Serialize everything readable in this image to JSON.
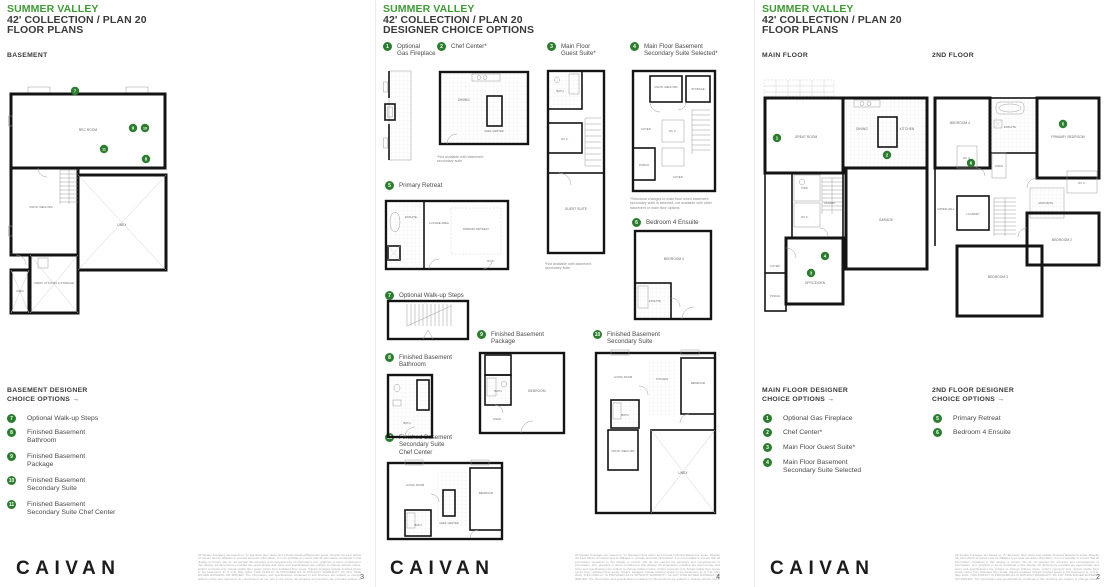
{
  "colors": {
    "accent_green": "#3f9b35",
    "marker_green": "#2c7d2f",
    "wall_black": "#141414"
  },
  "pages": {
    "basement": {
      "title": "SUMMER VALLEY",
      "subtitle": "42' COLLECTION / PLAN 20",
      "doc_type": "FLOOR PLANS",
      "section_label": "BASEMENT",
      "legend_heading": "BASEMENT DESIGNER\nCHOICE OPTIONS →",
      "legend_items": [
        {
          "num": "7",
          "label": "Optional Walk-up Steps"
        },
        {
          "num": "8",
          "label": "Finished Basement\nBathroom"
        },
        {
          "num": "9",
          "label": "Finished Basement\nPackage"
        },
        {
          "num": "10",
          "label": "Finished Basement\nSecondary Suite"
        },
        {
          "num": "11",
          "label": "Finished Basement\nSecondary Suite Chef Center"
        }
      ],
      "page_number": "3"
    },
    "options": {
      "title": "SUMMER VALLEY",
      "subtitle": "42' COLLECTION / PLAN 20",
      "doc_type": "DESIGNER CHOICE OPTIONS",
      "items": [
        {
          "num": "1",
          "label": "Optional\nGas Fireplace"
        },
        {
          "num": "2",
          "label": "Chef Center*",
          "note": "*Not available with basement\nsecondary suite."
        },
        {
          "num": "3",
          "label": "Main Floor\nGuest Suite*",
          "note": "*Not available with basement\nsecondary suite."
        },
        {
          "num": "4",
          "label": "Main Floor Basement\nSecondary Suite Selected*",
          "note": "*Structural changes to main floor when basement\nsecondary suite is selected, not available with other\nbasement or main floor options."
        },
        {
          "num": "5",
          "label": "Primary Retreat"
        },
        {
          "num": "6",
          "label": "Bedroom 4 Ensuite"
        },
        {
          "num": "7",
          "label": "Optional Walk-up Steps"
        },
        {
          "num": "8",
          "label": "Finished Basement\nBathroom"
        },
        {
          "num": "9",
          "label": "Finished Basement\nPackage"
        },
        {
          "num": "10",
          "label": "Finished Basement\nSecondary Suite"
        },
        {
          "num": "11",
          "label": "Finished Basement\nSecondary Suite\nChef Center"
        }
      ],
      "page_number": "4"
    },
    "floors": {
      "title": "SUMMER VALLEY",
      "subtitle": "42' COLLECTION / PLAN 20",
      "doc_type": "FLOOR PLANS",
      "section_label_main": "MAIN FLOOR",
      "section_label_2nd": "2ND FLOOR",
      "legend_main_heading": "MAIN FLOOR DESIGNER\nCHOICE OPTIONS →",
      "legend_main_items": [
        {
          "num": "1",
          "label": "Optional Gas Fireplace"
        },
        {
          "num": "2",
          "label": "Chef Center*"
        },
        {
          "num": "3",
          "label": "Main Floor Guest Suite*"
        },
        {
          "num": "4",
          "label": "Main Floor Basement\nSecondary Suite Selected"
        }
      ],
      "legend_2nd_heading": "2ND FLOOR DESIGNER\nCHOICE OPTIONS →",
      "legend_2nd_items": [
        {
          "num": "5",
          "label": "Primary Retreat"
        },
        {
          "num": "6",
          "label": "Bedroom 4 Ensuite"
        }
      ],
      "page_number": "2"
    }
  },
  "plans": {
    "basement": {
      "rooms": [
        "REC ROOM",
        "UNFIN. MECH RM",
        "UNEX",
        "UNFIN. UTILITIES & STORAGE",
        "UNEX"
      ],
      "markers": [
        "7",
        "9",
        "10",
        "11",
        "8"
      ]
    },
    "chef_center": {
      "rooms": [
        "DINING",
        "CHEF CENTER"
      ]
    },
    "guest_suite": {
      "rooms": [
        "BATH",
        "W.I.C.",
        "GUEST SUITE"
      ]
    },
    "secondary_selected": {
      "rooms": [
        "UNFIN. MECH RM",
        "STORAGE",
        "FOYER",
        "W.I.C.",
        "PORCH",
        "FOYER"
      ]
    },
    "primary_retreat": {
      "rooms": [
        "ENSUITE",
        "LOUNGE AREA",
        "PRIMARY RETREAT",
        "W.I.C."
      ]
    },
    "bedroom4_ensuite": {
      "rooms": [
        "BEDROOM 4",
        "ENSUITE"
      ]
    },
    "basement_bath": {
      "rooms": [
        "BATH"
      ]
    },
    "basement_package": {
      "rooms": [
        "BATH",
        "BEDROOM",
        "LINEN"
      ]
    },
    "secondary_suite": {
      "rooms": [
        "LIVING ROOM",
        "KITCHEN",
        "BEDROOM",
        "BATH",
        "UNFIN. MECH RM",
        "UNEX"
      ]
    },
    "secondary_chef": {
      "rooms": [
        "LIVING ROOM",
        "CHEF CENTER",
        "BEDROOM",
        "BATH"
      ]
    },
    "main_floor": {
      "rooms": [
        "GREAT ROOM",
        "DINING",
        "KITCHEN",
        "PWD.",
        "MUDRM.",
        "W.I.C.",
        "GARAGE",
        "OFFICE/DEN",
        "FOYER",
        "PORCH"
      ],
      "markers": [
        "1",
        "2",
        "4",
        "3"
      ]
    },
    "second_floor": {
      "rooms": [
        "BEDROOM 4",
        "ENSUITE",
        "LINEN",
        "PRIMARY BEDROOM",
        "W.I.C.",
        "MAIN BATH",
        "UPPER HALL",
        "LAUNDRY",
        "BEDROOM 2",
        "BEDROOM 3"
      ],
      "markers": [
        "5",
        "6"
      ]
    }
  },
  "footer": {
    "logo": "CAIVAN",
    "disclaimer": "All Square Footages are based on \"A\" Elevation floor plans and include Finished Basement areas. Despite the best efforts of Caivan and its affiliates to provide accurate information, it is not possible to ensure that all information contained in this display is correct. We do not warrant the accuracy and completeness of information, text, graphics or items contained in this display. All dimensions provided are approximate and sizes and specifications are subject to change without notice. Artist's concepts only. Actual usable floor space varies from indicated floor areas. Square footages include finished space in the basement; E. & O.E. May 2020. THIS DISPLAY IS PROVIDED AS IS WITHOUT WARRANTY OF ANY KIND EITHER EXPRESS OR IMPLIED. The information and specifications contained in this brochure are subject to change without notice and represent no commitment on our part in the future. All products and services are provided subject to applicable taxes and accompanying terms and conditions."
  }
}
